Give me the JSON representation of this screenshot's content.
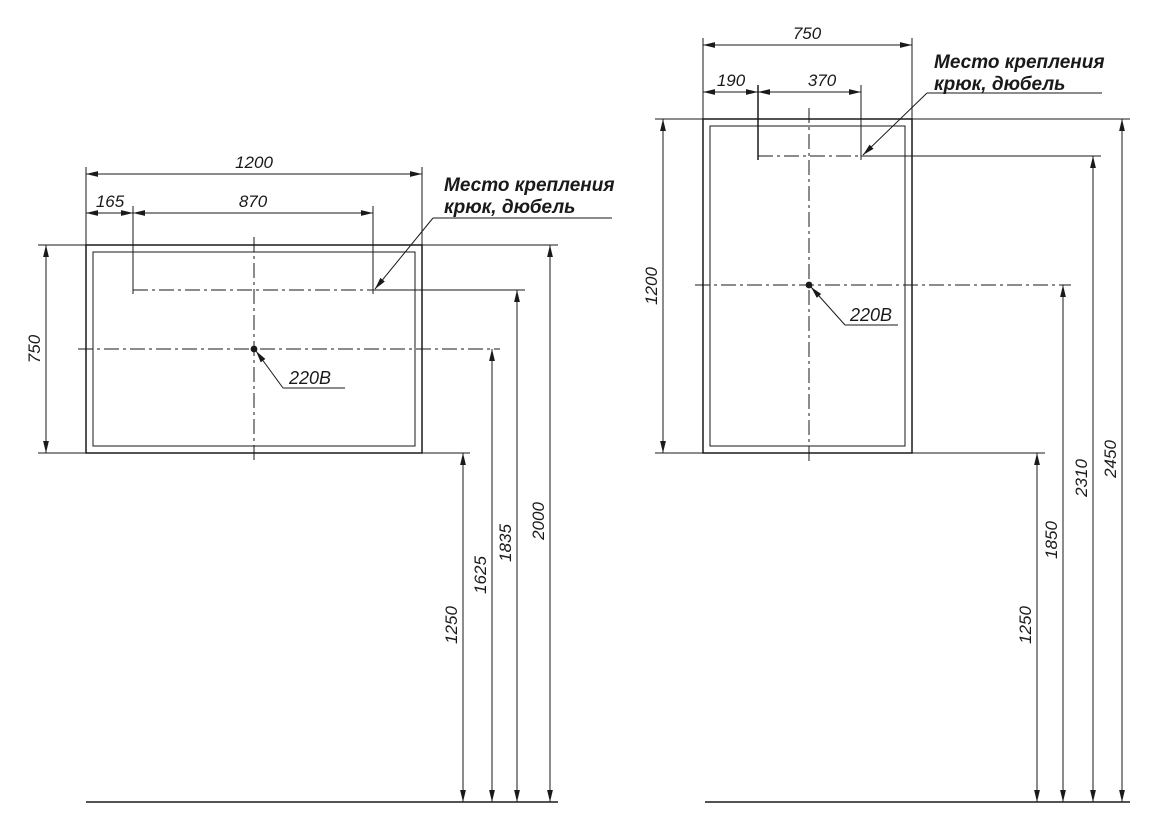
{
  "colors": {
    "line": "#1a1a1a",
    "background": "#ffffff"
  },
  "left": {
    "width": "1200",
    "hook_offset": "165",
    "hook_span": "870",
    "height": "750",
    "note1": "Место крепления",
    "note2": "крюк, дюбель",
    "outlet": "220В",
    "h_bottom": "1250",
    "h_outlet": "1625",
    "h_hook": "1835",
    "h_top": "2000"
  },
  "right": {
    "width": "750",
    "hook_offset": "190",
    "hook_span": "370",
    "height": "1200",
    "note1": "Место крепления",
    "note2": "крюк, дюбель",
    "outlet": "220В",
    "h_bottom": "1250",
    "h_outlet": "1850",
    "h_hook": "2310",
    "h_top": "2450"
  }
}
